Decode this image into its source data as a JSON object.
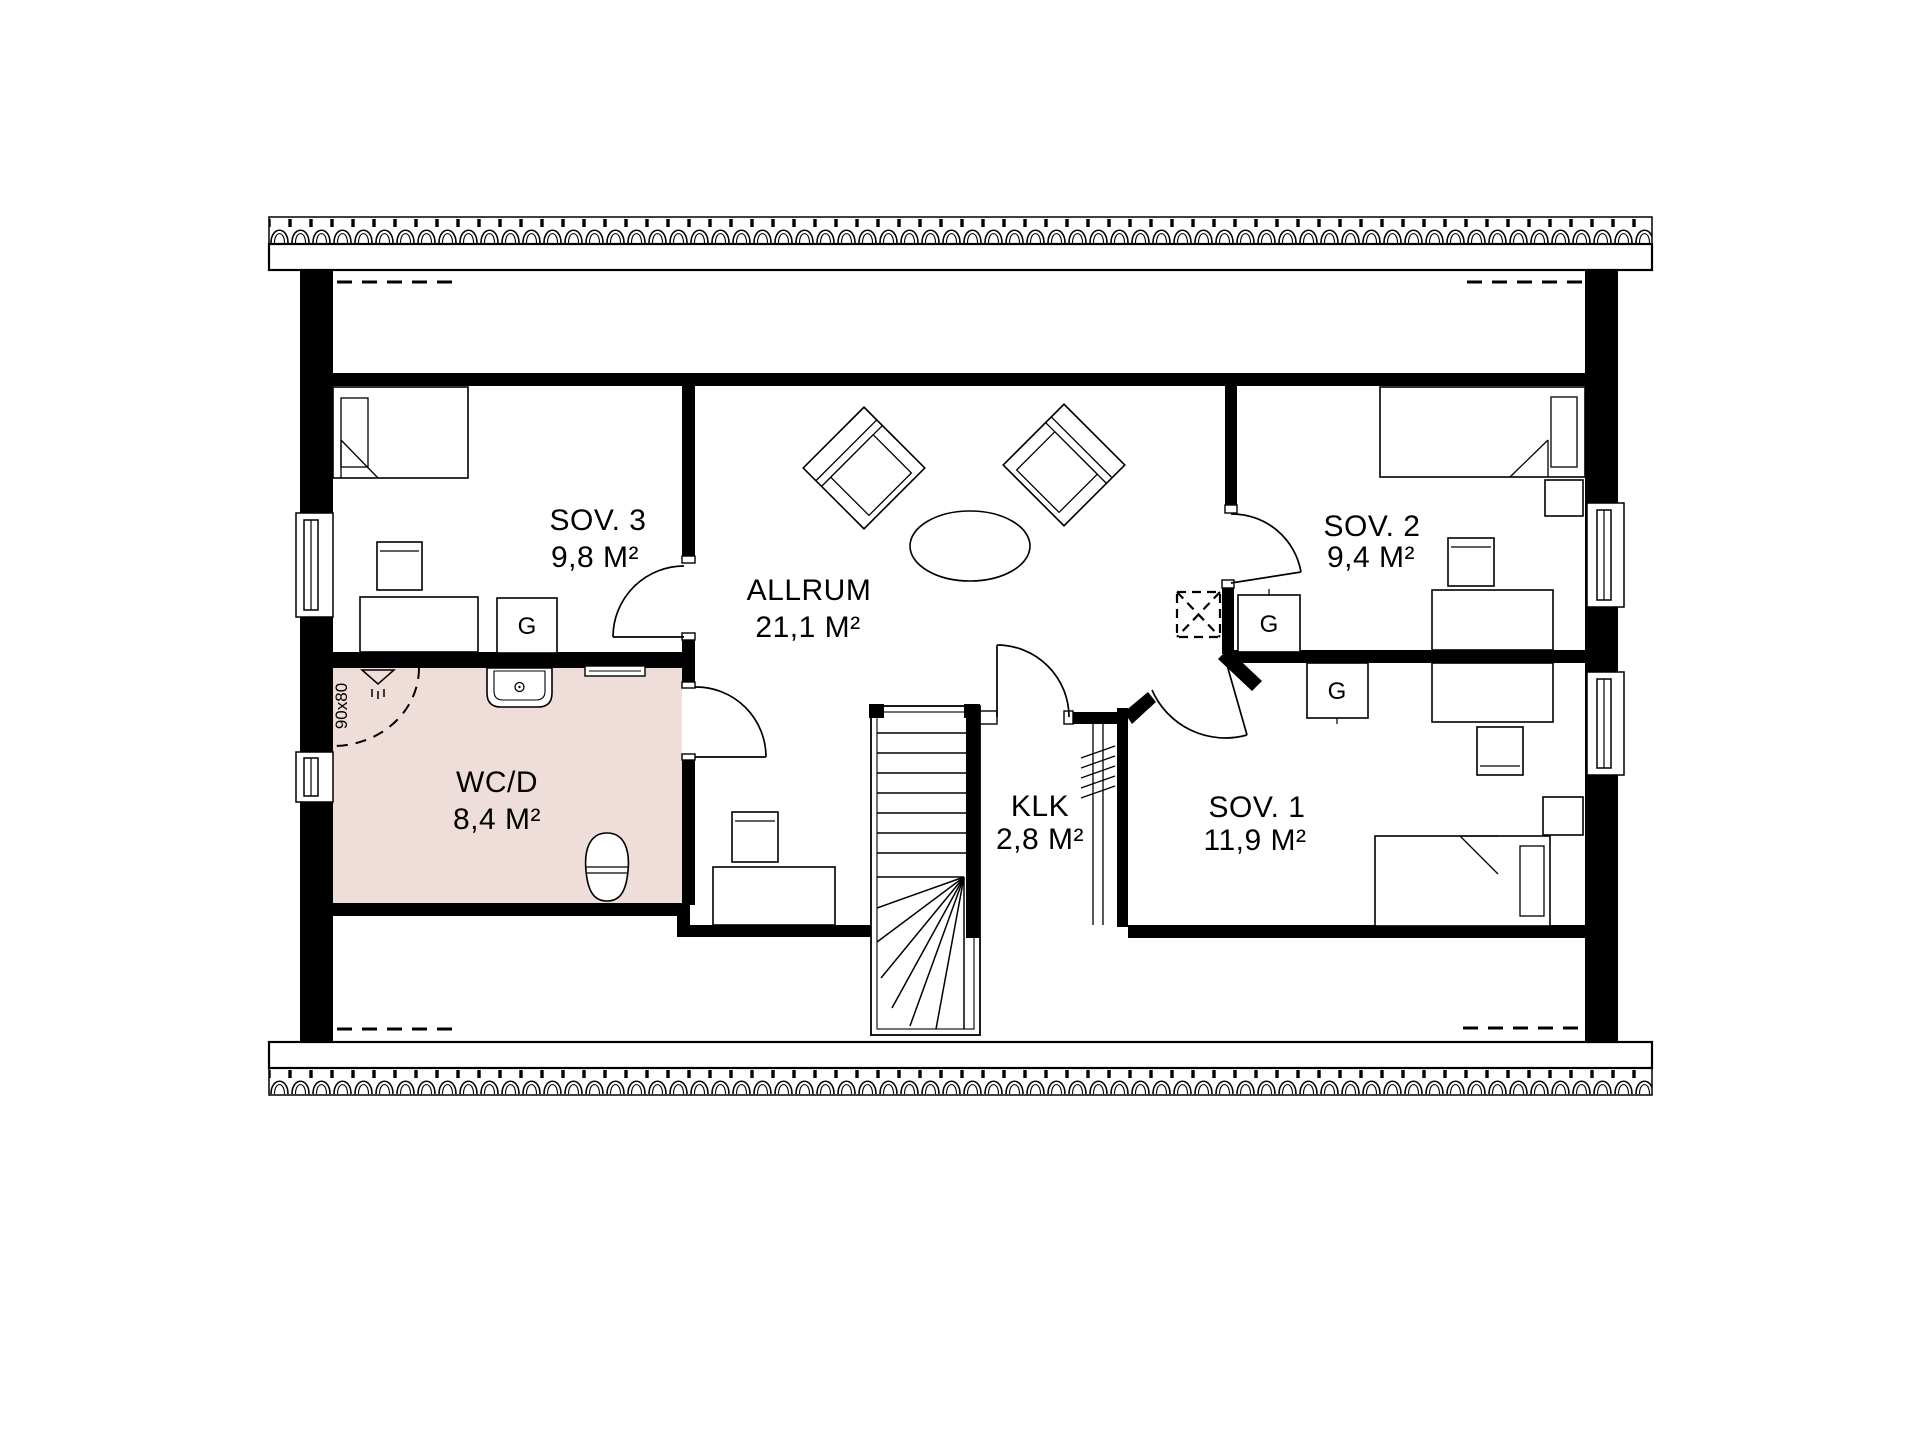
{
  "floorplan": {
    "kind": "architectural-floor-plan",
    "rooms": [
      {
        "id": "sov3",
        "name": "SOV. 3",
        "area": "9,8 M²"
      },
      {
        "id": "allrum",
        "name": "ALLRUM",
        "area": "21,1 M²"
      },
      {
        "id": "sov2",
        "name": "SOV. 2",
        "area": "9,4 M²"
      },
      {
        "id": "wcd",
        "name": "WC/D",
        "area": "8,4 M²"
      },
      {
        "id": "klk",
        "name": "KLK",
        "area": "2,8 M²"
      },
      {
        "id": "sov1",
        "name": "SOV. 1",
        "area": "11,9 M²"
      }
    ],
    "annotations": {
      "shower_size": "90x80",
      "wardrobe_label": "G"
    },
    "colors": {
      "wet_room_floor": "#eeddd8",
      "wall": "#000000",
      "background": "#ffffff"
    }
  }
}
